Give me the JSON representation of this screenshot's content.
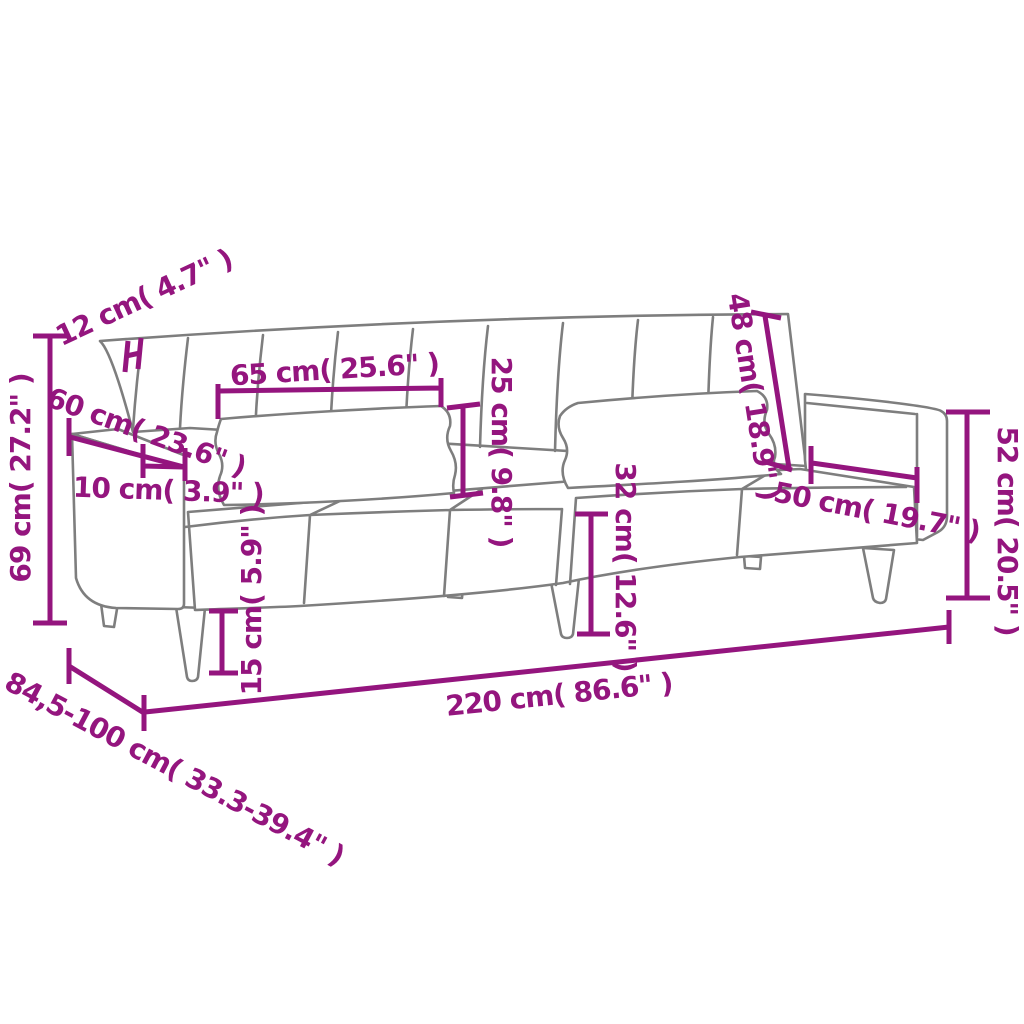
{
  "diagram": {
    "title": "Sofa bed dimension diagram",
    "colors": {
      "dimension_text": "#94157e",
      "outline": "#7e7e7e",
      "background": "#ffffff"
    },
    "dimensions": [
      {
        "id": "backrest-thickness",
        "label": "12 cm( 4.7\" )"
      },
      {
        "id": "overall-height",
        "label": "69 cm( 27.2\" )"
      },
      {
        "id": "armrest-depth",
        "label": "60 cm( 23.6\" )"
      },
      {
        "id": "armrest-width",
        "label": "10 cm( 3.9\" )"
      },
      {
        "id": "pillow-length",
        "label": "65 cm( 25.6\" )"
      },
      {
        "id": "pillow-height",
        "label": "25 cm( 9.8\" )"
      },
      {
        "id": "backrest-height",
        "label": "48 cm( 18.9\" )"
      },
      {
        "id": "seat-depth",
        "label": "50 cm( 19.7\" )"
      },
      {
        "id": "armrest-height",
        "label": "52 cm( 20.5\" )"
      },
      {
        "id": "seat-height",
        "label": "32 cm( 12.6\" )"
      },
      {
        "id": "leg-height",
        "label": "15 cm( 5.9\" )"
      },
      {
        "id": "overall-length",
        "label": "220 cm( 86.6\" )"
      },
      {
        "id": "overall-depth",
        "label": "84,5-100 cm( 33.3-39.4\" )"
      }
    ]
  }
}
